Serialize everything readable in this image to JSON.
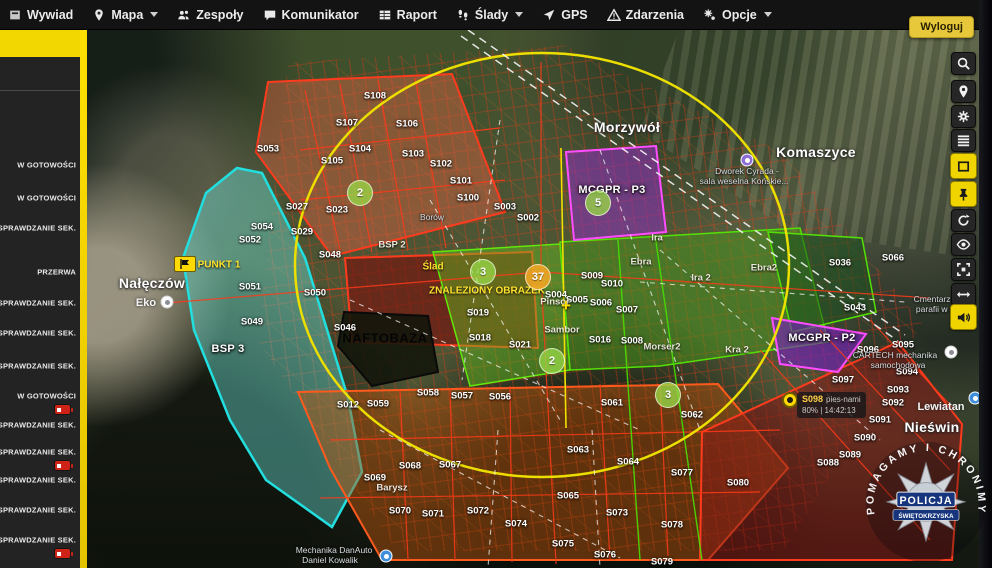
{
  "menubar": {
    "items": [
      {
        "label": "Wywiad",
        "icon": "panel",
        "caret": false
      },
      {
        "label": "Mapa",
        "icon": "pin",
        "caret": true
      },
      {
        "label": "Zespoły",
        "icon": "people",
        "caret": false
      },
      {
        "label": "Komunikator",
        "icon": "chat",
        "caret": false
      },
      {
        "label": "Raport",
        "icon": "table",
        "caret": false
      },
      {
        "label": "Ślady",
        "icon": "steps",
        "caret": true
      },
      {
        "label": "GPS",
        "icon": "cursor",
        "caret": false
      },
      {
        "label": "Zdarzenia",
        "icon": "warning",
        "caret": false
      },
      {
        "label": "Opcje",
        "icon": "gears",
        "caret": true
      }
    ],
    "logout_label": "Wyloguj"
  },
  "sidebar": {
    "items": [
      {
        "label": "W GOTOWOŚCI",
        "y": 165,
        "battery_low": false
      },
      {
        "label": "W GOTOWOŚCI",
        "y": 198,
        "battery_low": false
      },
      {
        "label": "SPRAWDZANIE SEK.",
        "y": 228,
        "battery_low": false
      },
      {
        "label": "PRZERWA",
        "y": 272,
        "battery_low": false
      },
      {
        "label": "SPRAWDZANIE SEK.",
        "y": 303,
        "battery_low": false
      },
      {
        "label": "SPRAWDZANIE SEK.",
        "y": 333,
        "battery_low": false
      },
      {
        "label": "SPRAWDZANIE SEK.",
        "y": 366,
        "battery_low": false
      },
      {
        "label": "W GOTOWOŚCI",
        "y": 396,
        "battery_low": true
      },
      {
        "label": "SPRAWDZANIE SEK.",
        "y": 425,
        "battery_low": false
      },
      {
        "label": "SPRAWDZANIE SEK.",
        "y": 452,
        "battery_low": true
      },
      {
        "label": "SPRAWDZANIE SEK.",
        "y": 480,
        "battery_low": false
      },
      {
        "label": "SPRAWDZANIE SEK.",
        "y": 510,
        "battery_low": false
      },
      {
        "label": "SPRAWDZANIE SEK.",
        "y": 540,
        "battery_low": true
      }
    ]
  },
  "toolbar": {
    "buttons": [
      {
        "name": "search",
        "icon": "search",
        "active": false
      },
      {
        "name": "locate",
        "icon": "pin",
        "active": false
      },
      {
        "name": "settings",
        "icon": "gear",
        "active": false
      },
      {
        "name": "layers",
        "icon": "layers",
        "active": false
      },
      {
        "name": "select-area",
        "icon": "rect",
        "active": true
      },
      {
        "name": "pin-mode",
        "icon": "pushpin",
        "active": true
      },
      {
        "name": "refresh",
        "icon": "refresh",
        "active": false
      },
      {
        "name": "visibility",
        "icon": "eye",
        "active": false
      },
      {
        "name": "fit-bounds",
        "icon": "crop",
        "active": false
      },
      {
        "name": "measure",
        "icon": "arrows",
        "active": false
      },
      {
        "name": "sound",
        "icon": "speaker",
        "active": true
      }
    ]
  },
  "map": {
    "labels": [
      {
        "t": "S108",
        "x": 375,
        "y": 96,
        "c": "sec"
      },
      {
        "t": "S107",
        "x": 347,
        "y": 123,
        "c": "sec"
      },
      {
        "t": "S106",
        "x": 407,
        "y": 124,
        "c": "sec"
      },
      {
        "t": "S105",
        "x": 332,
        "y": 161,
        "c": "sec"
      },
      {
        "t": "S104",
        "x": 360,
        "y": 149,
        "c": "sec"
      },
      {
        "t": "S103",
        "x": 413,
        "y": 154,
        "c": "sec"
      },
      {
        "t": "S102",
        "x": 441,
        "y": 164,
        "c": "sec"
      },
      {
        "t": "S101",
        "x": 461,
        "y": 181,
        "c": "sec"
      },
      {
        "t": "S100",
        "x": 468,
        "y": 198,
        "c": "sec"
      },
      {
        "t": "S003",
        "x": 505,
        "y": 207,
        "c": "sec"
      },
      {
        "t": "S002",
        "x": 528,
        "y": 218,
        "c": "sec"
      },
      {
        "t": "S053",
        "x": 268,
        "y": 149,
        "c": "sec"
      },
      {
        "t": "S054",
        "x": 262,
        "y": 227,
        "c": "sec"
      },
      {
        "t": "S029",
        "x": 302,
        "y": 232,
        "c": "sec"
      },
      {
        "t": "S027",
        "x": 297,
        "y": 207,
        "c": "sec"
      },
      {
        "t": "S023",
        "x": 337,
        "y": 210,
        "c": "sec"
      },
      {
        "t": "S052",
        "x": 250,
        "y": 240,
        "c": "sec"
      },
      {
        "t": "S051",
        "x": 250,
        "y": 287,
        "c": "sec"
      },
      {
        "t": "S050",
        "x": 315,
        "y": 293,
        "c": "sec"
      },
      {
        "t": "S049",
        "x": 252,
        "y": 322,
        "c": "sec"
      },
      {
        "t": "S048",
        "x": 330,
        "y": 255,
        "c": "sec"
      },
      {
        "t": "S046",
        "x": 345,
        "y": 328,
        "c": "sec"
      },
      {
        "t": "S019",
        "x": 478,
        "y": 313,
        "c": "sec"
      },
      {
        "t": "S018",
        "x": 480,
        "y": 338,
        "c": "sec"
      },
      {
        "t": "S021",
        "x": 520,
        "y": 345,
        "c": "sec"
      },
      {
        "t": "S004",
        "x": 556,
        "y": 295,
        "c": "sec"
      },
      {
        "t": "S005",
        "x": 577,
        "y": 300,
        "c": "sec"
      },
      {
        "t": "S006",
        "x": 601,
        "y": 303,
        "c": "sec"
      },
      {
        "t": "S007",
        "x": 627,
        "y": 310,
        "c": "sec"
      },
      {
        "t": "S008",
        "x": 632,
        "y": 341,
        "c": "sec"
      },
      {
        "t": "S009",
        "x": 592,
        "y": 276,
        "c": "sec"
      },
      {
        "t": "S010",
        "x": 612,
        "y": 284,
        "c": "sec"
      },
      {
        "t": "S016",
        "x": 600,
        "y": 340,
        "c": "sec"
      },
      {
        "t": "S036",
        "x": 840,
        "y": 263,
        "c": "sec"
      },
      {
        "t": "S043",
        "x": 855,
        "y": 308,
        "c": "sec"
      },
      {
        "t": "S066",
        "x": 893,
        "y": 258,
        "c": "sec"
      },
      {
        "t": "S012",
        "x": 348,
        "y": 405,
        "c": "sec"
      },
      {
        "t": "S059",
        "x": 378,
        "y": 404,
        "c": "sec"
      },
      {
        "t": "S058",
        "x": 428,
        "y": 393,
        "c": "sec"
      },
      {
        "t": "S057",
        "x": 462,
        "y": 396,
        "c": "sec"
      },
      {
        "t": "S056",
        "x": 500,
        "y": 397,
        "c": "sec"
      },
      {
        "t": "S061",
        "x": 612,
        "y": 403,
        "c": "sec"
      },
      {
        "t": "S062",
        "x": 692,
        "y": 415,
        "c": "sec"
      },
      {
        "t": "S063",
        "x": 578,
        "y": 450,
        "c": "sec"
      },
      {
        "t": "S064",
        "x": 628,
        "y": 462,
        "c": "sec"
      },
      {
        "t": "S065",
        "x": 568,
        "y": 496,
        "c": "sec"
      },
      {
        "t": "S067",
        "x": 450,
        "y": 465,
        "c": "sec"
      },
      {
        "t": "S068",
        "x": 410,
        "y": 466,
        "c": "sec"
      },
      {
        "t": "S069",
        "x": 375,
        "y": 478,
        "c": "sec"
      },
      {
        "t": "S070",
        "x": 400,
        "y": 511,
        "c": "sec"
      },
      {
        "t": "S071",
        "x": 433,
        "y": 514,
        "c": "sec"
      },
      {
        "t": "S072",
        "x": 478,
        "y": 511,
        "c": "sec"
      },
      {
        "t": "S073",
        "x": 617,
        "y": 513,
        "c": "sec"
      },
      {
        "t": "S074",
        "x": 516,
        "y": 524,
        "c": "sec"
      },
      {
        "t": "S075",
        "x": 563,
        "y": 544,
        "c": "sec"
      },
      {
        "t": "S076",
        "x": 605,
        "y": 555,
        "c": "sec"
      },
      {
        "t": "S077",
        "x": 682,
        "y": 473,
        "c": "sec"
      },
      {
        "t": "S078",
        "x": 672,
        "y": 525,
        "c": "sec"
      },
      {
        "t": "S079",
        "x": 662,
        "y": 562,
        "c": "sec"
      },
      {
        "t": "S080",
        "x": 738,
        "y": 483,
        "c": "sec"
      },
      {
        "t": "S088",
        "x": 828,
        "y": 463,
        "c": "sec"
      },
      {
        "t": "S089",
        "x": 850,
        "y": 455,
        "c": "sec"
      },
      {
        "t": "S090",
        "x": 865,
        "y": 438,
        "c": "sec"
      },
      {
        "t": "S091",
        "x": 880,
        "y": 420,
        "c": "sec"
      },
      {
        "t": "S092",
        "x": 893,
        "y": 403,
        "c": "sec"
      },
      {
        "t": "S093",
        "x": 898,
        "y": 390,
        "c": "sec"
      },
      {
        "t": "S094",
        "x": 907,
        "y": 372,
        "c": "sec"
      },
      {
        "t": "S095",
        "x": 903,
        "y": 345,
        "c": "sec"
      },
      {
        "t": "S096",
        "x": 868,
        "y": 350,
        "c": "sec"
      },
      {
        "t": "S097",
        "x": 843,
        "y": 380,
        "c": "sec"
      },
      {
        "t": "MCGPR - P3",
        "x": 612,
        "y": 190,
        "c": "unit"
      },
      {
        "t": "MCGPR - P2",
        "x": 822,
        "y": 338,
        "c": "unit"
      },
      {
        "t": "BSP 3",
        "x": 228,
        "y": 349,
        "c": "unit"
      },
      {
        "t": "NAFTOBAZA",
        "x": 385,
        "y": 338,
        "c": "blk"
      },
      {
        "t": "PUNKT 1",
        "x": 219,
        "y": 265,
        "c": "yel"
      },
      {
        "t": "Ślad",
        "x": 433,
        "y": 267,
        "c": "yel"
      },
      {
        "t": "ZNALEZIONY OBRAZEK",
        "x": 487,
        "y": 291,
        "c": "yel"
      },
      {
        "t": "Nałęczów",
        "x": 152,
        "y": 283,
        "c": "town"
      },
      {
        "t": "Morzywół",
        "x": 627,
        "y": 127,
        "c": "town"
      },
      {
        "t": "Komaszyce",
        "x": 816,
        "y": 152,
        "c": "town"
      },
      {
        "t": "Nieświn",
        "x": 932,
        "y": 427,
        "c": "town"
      },
      {
        "t": "Eko",
        "x": 146,
        "y": 303,
        "c": "town2"
      },
      {
        "t": "Lewiatan",
        "x": 941,
        "y": 407,
        "c": "town2"
      },
      {
        "t": "Ira",
        "x": 657,
        "y": 238,
        "c": "trk"
      },
      {
        "t": "Ebra",
        "x": 641,
        "y": 262,
        "c": "trk"
      },
      {
        "t": "Ira 2",
        "x": 701,
        "y": 278,
        "c": "trk"
      },
      {
        "t": "Ebra2",
        "x": 764,
        "y": 268,
        "c": "trk"
      },
      {
        "t": "Morser2",
        "x": 662,
        "y": 347,
        "c": "trk"
      },
      {
        "t": "Kra 2",
        "x": 737,
        "y": 350,
        "c": "trk"
      },
      {
        "t": "Pinsor",
        "x": 555,
        "y": 302,
        "c": "trk"
      },
      {
        "t": "Sambor",
        "x": 562,
        "y": 330,
        "c": "trk"
      },
      {
        "t": "BSP 2",
        "x": 392,
        "y": 245,
        "c": "trk"
      },
      {
        "t": "Barysz",
        "x": 392,
        "y": 488,
        "c": "trk"
      },
      {
        "t": "Dworek Cyrada -",
        "x": 747,
        "y": 171,
        "c": "poi"
      },
      {
        "t": "sala weselna Końskie...",
        "x": 744,
        "y": 181,
        "c": "poi"
      },
      {
        "t": "Cmentarz pa",
        "x": 938,
        "y": 299,
        "c": "poi"
      },
      {
        "t": "parafii w N",
        "x": 936,
        "y": 309,
        "c": "poi"
      },
      {
        "t": "CARTECH mechanika",
        "x": 895,
        "y": 355,
        "c": "poi"
      },
      {
        "t": "samochodowa",
        "x": 898,
        "y": 365,
        "c": "poi"
      },
      {
        "t": "Mechanika DanAuto",
        "x": 334,
        "y": 550,
        "c": "poi"
      },
      {
        "t": "Daniel Kowalik",
        "x": 330,
        "y": 560,
        "c": "poi"
      },
      {
        "t": "Borów",
        "x": 432,
        "y": 217,
        "c": "poi"
      }
    ],
    "markers": [
      {
        "type": "num",
        "n": "2",
        "x": 360,
        "y": 193
      },
      {
        "type": "num",
        "n": "3",
        "x": 483,
        "y": 272
      },
      {
        "type": "num",
        "n": "5",
        "x": 598,
        "y": 203
      },
      {
        "type": "num",
        "n": "2",
        "x": 552,
        "y": 361
      },
      {
        "type": "num",
        "n": "3",
        "x": 668,
        "y": 395
      },
      {
        "type": "num-orange",
        "n": "37",
        "x": 538,
        "y": 277
      },
      {
        "type": "poi-purple",
        "x": 747,
        "y": 160
      },
      {
        "type": "poi-white",
        "x": 951,
        "y": 352
      },
      {
        "type": "poi-blue",
        "x": 975,
        "y": 398
      },
      {
        "type": "poi-blue",
        "x": 386,
        "y": 556
      },
      {
        "type": "poi-white",
        "x": 167,
        "y": 302
      },
      {
        "type": "pin-yellow",
        "x": 790,
        "y": 400
      },
      {
        "type": "flag-yellow",
        "x": 185,
        "y": 264
      },
      {
        "type": "cross-yellow",
        "x": 566,
        "y": 306
      }
    ],
    "tracker_tooltip": {
      "id": "S098",
      "name": "pies-nami",
      "status": "80% | 14:42:13"
    }
  },
  "badge": {
    "arc_text": "POMAGAMY I CHRONIMY",
    "org": "POLICJA",
    "region": "ŚWIĘTOKRZYSKA"
  },
  "colors": {
    "accent_yellow": "#f2d800",
    "alert_red": "#ff3a18",
    "sector_green": "#55e005",
    "unit_purple": "#c13cf0",
    "search_cyan": "#2adede"
  }
}
